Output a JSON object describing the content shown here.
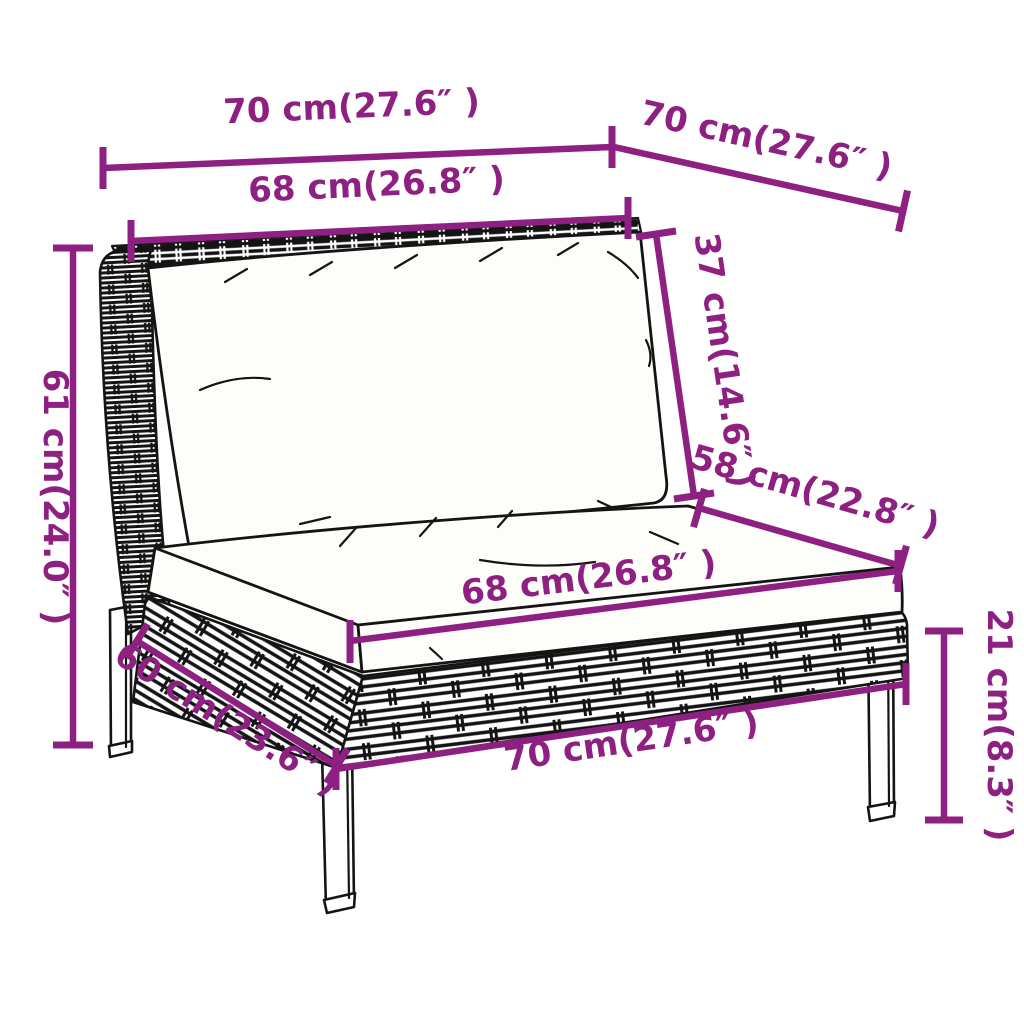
{
  "colors": {
    "dimension": "#8d2080",
    "line": "#141414",
    "cushion": "#fdfdfa",
    "background": "#ffffff"
  },
  "dimensions": {
    "top_width": "70 cm(27.6″ )",
    "top_depth": "70 cm(27.6″ )",
    "back_cushion_width": "68 cm(26.8″ )",
    "overall_height": "61 cm(24.0″ )",
    "backrest_height": "37 cm(14.6″ )",
    "seat_depth": "58 cm(22.8″ )",
    "seat_cushion_width": "68 cm(26.8″ )",
    "base_depth": "60 cm(23.6″ )",
    "base_width": "70 cm(27.6″ )",
    "leg_height": "21 cm(8.3″ )"
  }
}
